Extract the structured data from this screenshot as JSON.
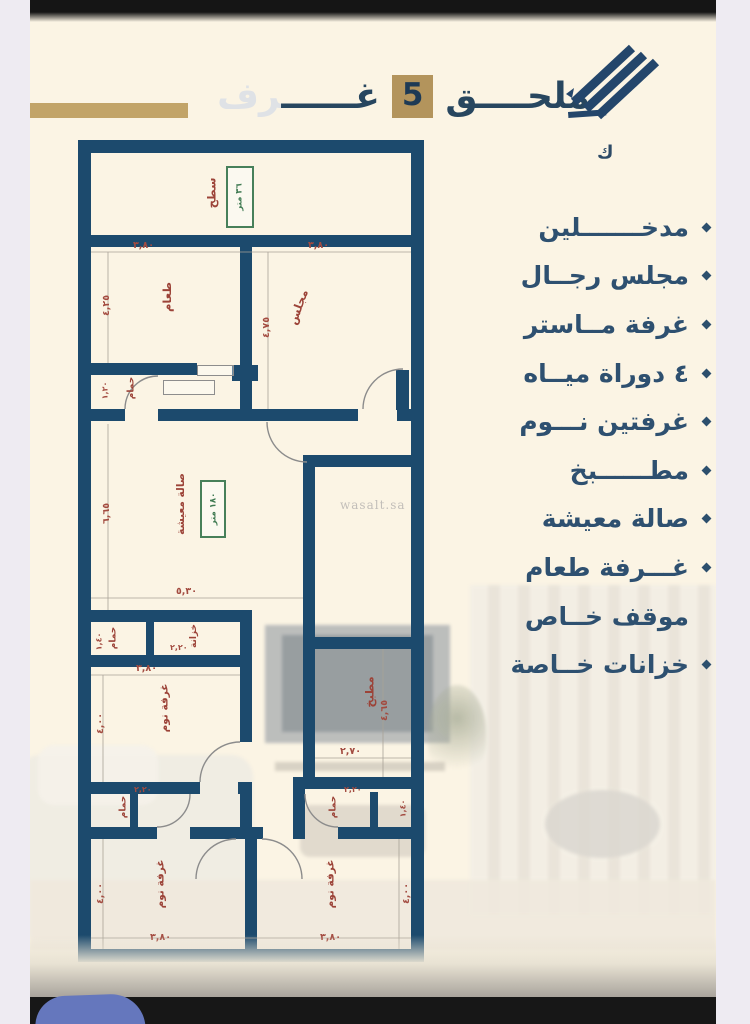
{
  "header": {
    "title_pre": "ملحــــق",
    "title_num": "5",
    "title_post_head": "غــــــ",
    "title_post_tail": "رف",
    "logo_caption": "ك"
  },
  "features": {
    "items": [
      {
        "label": "مدخـــــــلين",
        "bullet": true
      },
      {
        "label": "مجلس رجــال",
        "bullet": true
      },
      {
        "label": "غرفة مــاستر",
        "bullet": true
      },
      {
        "label": "٤ دوراة ميــاه",
        "bullet": true
      },
      {
        "label": "غرفتين نـــوم",
        "bullet": true
      },
      {
        "label": "مطــــــبخ",
        "bullet": true
      },
      {
        "label": "صالة معيشة",
        "bullet": true
      },
      {
        "label": "غـــرفة طعام",
        "bullet": true
      },
      {
        "label": "موقف خــاص",
        "bullet": false
      },
      {
        "label": "خزانات خــاصة",
        "bullet": true
      }
    ]
  },
  "plan": {
    "labels": {
      "roof": "سطح",
      "dining": "طعام",
      "majlis": "مجلس",
      "living": "صالة معيشة",
      "kitchen": "مطبخ",
      "bedroom": "غرفة نوم",
      "bath": "حمام",
      "closet": "خزانة"
    },
    "areas": {
      "roof": "٣٦ متر",
      "living": "١٨٠ متر"
    },
    "dims": {
      "w380": "٣,٨٠",
      "h425": "٤,٢٥",
      "h475": "٤,٧٥",
      "w530": "٥,٣٠",
      "h665": "٦,٦٥",
      "w270": "٢,٧٠",
      "h465": "٤,٦٥",
      "h400": "٤,٠٠",
      "w220": "٢,٢٠",
      "h140": "١,٤٠",
      "h120": "١,٢٠"
    },
    "watermark": "wasalt.sa"
  }
}
